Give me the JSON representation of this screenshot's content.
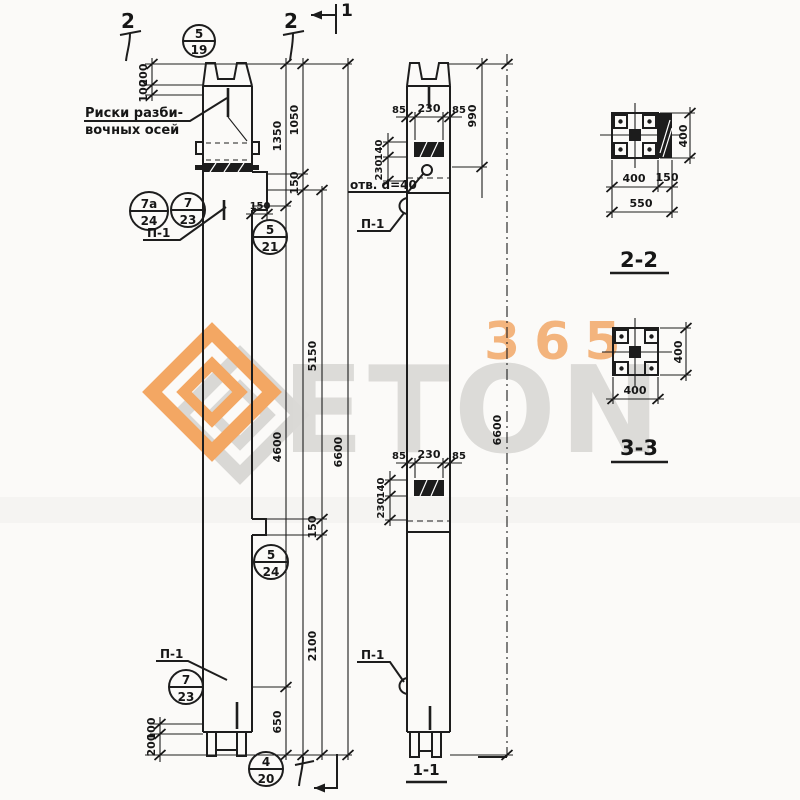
{
  "paper_color": "#fbfaf8",
  "ink_color": "#1d1d1d",
  "watermark": {
    "number": "365",
    "word": "ETON",
    "orange": "#f2a35f",
    "gray": "#d9d8d5"
  },
  "notes": {
    "axis1": "Риски разби-",
    "axis2": "вочных осей",
    "hole": "отв. d=40",
    "loop": "П-1"
  },
  "markers": {
    "m2a": "2",
    "m2b": "2",
    "m1": "1"
  },
  "circles": {
    "c1": {
      "t": "5",
      "b": "19"
    },
    "c2": {
      "t": "7а",
      "b": "24"
    },
    "c3": {
      "t": "7",
      "b": "23"
    },
    "c4": {
      "t": "5",
      "b": "21"
    },
    "c5": {
      "t": "5",
      "b": "24"
    },
    "c6": {
      "t": "7",
      "b": "23"
    },
    "c7": {
      "t": "4",
      "b": "20"
    }
  },
  "dims": {
    "top_left": {
      "a": "200",
      "b": "100"
    },
    "bottom_left": {
      "a": "100",
      "b": "200"
    },
    "chain": {
      "d1350": "1350",
      "d1050": "1050",
      "d150": "150",
      "d5150": "5150",
      "d4600": "4600",
      "d6600": "6600",
      "d150b": "150",
      "d2100": "2100",
      "d650": "650"
    },
    "corbel": "150",
    "right_top": {
      "l85": "85",
      "c230": "230",
      "r85": "85",
      "v140": "140",
      "v230": "230"
    },
    "right_mid": {
      "l85": "85",
      "c230": "230",
      "r85": "85",
      "v140": "140",
      "v230": "230"
    },
    "right_chain": {
      "d990": "990",
      "d6600": "6600"
    }
  },
  "sections": {
    "s22": {
      "title": "2-2",
      "height": "400",
      "w1": "400",
      "w2": "150",
      "total": "550"
    },
    "s33": {
      "title": "3-3",
      "height": "400",
      "width": "400"
    },
    "s11": {
      "title": "1-1"
    }
  }
}
